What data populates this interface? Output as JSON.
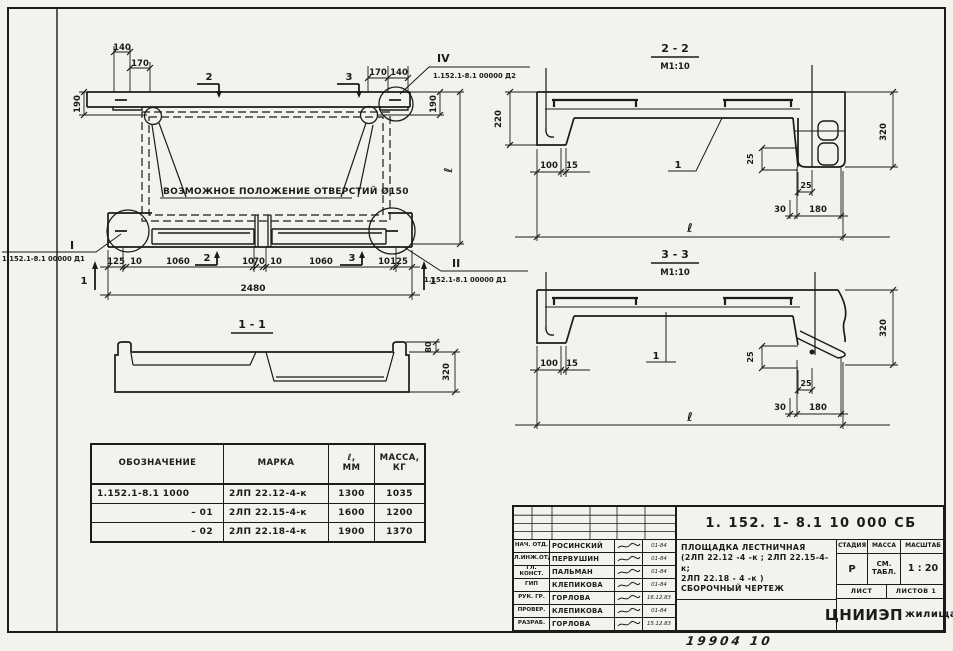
{
  "plan": {
    "note": "ВОЗМОЖНОЕ ПОЛОЖЕНИЕ ОТВЕРСТИЙ Ø150",
    "top_dims_left": [
      "140",
      "170"
    ],
    "top_dims_right": [
      "170",
      "140"
    ],
    "side_left_190": "190",
    "side_right_190": "190",
    "side_l": "ℓ",
    "bottom_dims": [
      "125",
      "10",
      "1060",
      "10",
      "70",
      "10",
      "1060",
      "10",
      "125"
    ],
    "total": "2480",
    "cut_mark_1": "1",
    "cut_mark_2": "2",
    "cut_mark_3": "3",
    "callout_I": {
      "label": "I",
      "ref": "1.152.1-8.1 00000 Д1"
    },
    "callout_II": {
      "label": "II",
      "ref": "1.152.1-8.1 00000 Д1"
    },
    "callout_IV": {
      "label": "IV",
      "ref": "1.152.1-8.1 00000 Д2"
    }
  },
  "section_1_1": {
    "title": "1 - 1",
    "d80": "80",
    "d320": "320"
  },
  "section_2_2": {
    "title": "2 - 2",
    "scale": "М1:10",
    "d220": "220",
    "d100": "100",
    "d15": "15",
    "d25v": "25",
    "d25h": "25",
    "d30": "30",
    "d180": "180",
    "d320": "320",
    "l": "ℓ",
    "bar_label": "1"
  },
  "section_3_3": {
    "title": "3 - 3",
    "scale": "М1:10",
    "d100": "100",
    "d15": "15",
    "d25v": "25",
    "d25h": "25",
    "d30": "30",
    "d180": "180",
    "d320": "320",
    "l": "ℓ",
    "bar_label": "1"
  },
  "table": {
    "headers": {
      "designation": "ОБОЗНАЧЕНИЕ",
      "mark": "МАРКА",
      "length1": "ℓ,",
      "length2": "ММ",
      "mass1": "МАССА,",
      "mass2": "КГ"
    },
    "rows": [
      {
        "designation": "1.152.1-8.1 1000",
        "mark": "2ЛП 22.12-4-к",
        "length": "1300",
        "mass": "1035"
      },
      {
        "designation": "– 01",
        "mark": "2ЛП 22.15-4-к",
        "length": "1600",
        "mass": "1200"
      },
      {
        "designation": "– 02",
        "mark": "2ЛП 22.18-4-к",
        "length": "1900",
        "mass": "1370"
      }
    ]
  },
  "title_block": {
    "doc_number": "1. 152. 1- 8.1    10 000 СБ",
    "title_line1": "ПЛОЩАДКА  ЛЕСТНИЧНАЯ",
    "title_line2": "(2ЛП 22.12 -4 -к ; 2ЛП 22.15-4-к;",
    "title_line3": "2ЛП 22.18 - 4 -к )",
    "title_line4": "СБОРОЧНЫЙ  ЧЕРТЕЖ",
    "stage_label": "СТАДИЯ",
    "mass_label": "МАССА",
    "scale_label": "МАСШТАБ",
    "stage_value": "Р",
    "mass_value1": "СМ.",
    "mass_value2": "ТАБЛ.",
    "scale_value": "1 : 20",
    "sheet_label": "ЛИСТ",
    "sheets_label": "ЛИСТОВ 1",
    "org_big": "ЦНИИЭП",
    "org_small": "жилища",
    "signatures": [
      {
        "role": "НАЧ. ОТД.",
        "name": "РОСИНСКИЙ",
        "date": "01-84"
      },
      {
        "role": "ГЛ.ИНЖ.ОТД",
        "name": "ПЕРВУШИН",
        "date": "01-84"
      },
      {
        "role": "ГЛ. КОНСТ.",
        "name": "ПАЛЬМАН",
        "date": "01-84"
      },
      {
        "role": "ГИП",
        "name": "КЛЕПИКОВА",
        "date": "01-84"
      },
      {
        "role": "РУК. ГР.",
        "name": "ГОРЛОВА",
        "date": "16.12.83"
      },
      {
        "role": "ПРОВЕР.",
        "name": "КЛЕПИКОВА",
        "date": "01-84"
      },
      {
        "role": "РАЗРАБ.",
        "name": "ГОРЛОВА",
        "date": "15.12.83"
      }
    ]
  },
  "handwritten": "19904   10"
}
